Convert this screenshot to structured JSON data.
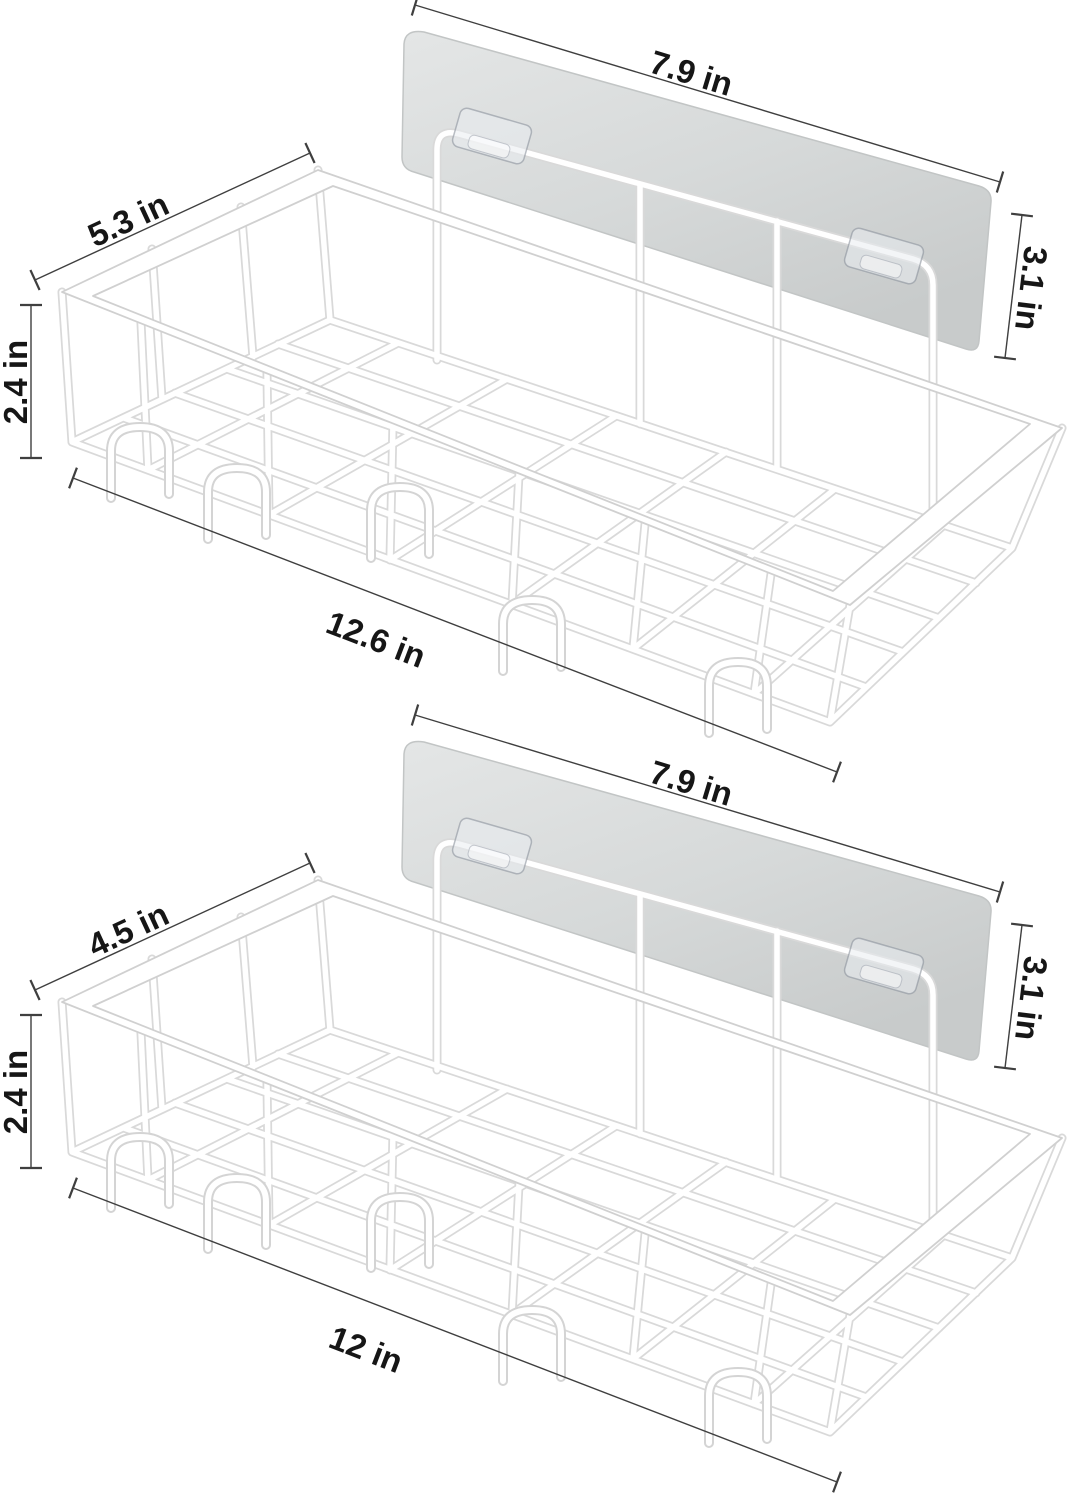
{
  "shelves": [
    {
      "name": "top-shelf",
      "labels": {
        "plate_width": "7.9 in",
        "basket_depth": "5.3 in",
        "plate_height": "3.1 in",
        "basket_height": "2.4 in",
        "basket_width": "12.6 in"
      }
    },
    {
      "name": "bottom-shelf",
      "labels": {
        "plate_width": "7.9 in",
        "basket_depth": "4.5 in",
        "plate_height": "3.1 in",
        "basket_height": "2.4 in",
        "basket_width": "12 in"
      }
    }
  ],
  "colors": {
    "background": "#ffffff",
    "plate_fill": "#d6d9d9",
    "wire_outline": "#d9d9d9",
    "wire_fill": "#ffffff",
    "dimension_line": "#3f3f3f",
    "label_text": "#161616",
    "adhesive_tab": "#eaedf1"
  }
}
